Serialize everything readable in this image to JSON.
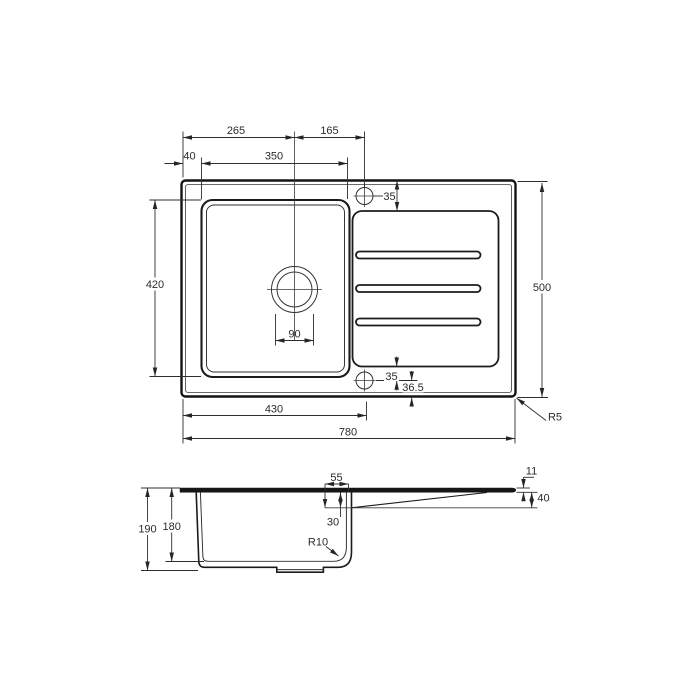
{
  "drawing": {
    "kind": "sink technical dimension drawing",
    "line_color": "#2b2b2b",
    "background": "#ffffff"
  },
  "plan": {
    "center_from_left": "265",
    "center_to_tap": "165",
    "bowl_offset": "40",
    "bowl_width": "350",
    "tap_top_offset": "35",
    "bowl_depth": "420",
    "drain_offset": "90",
    "tap_bottom_offset": "35",
    "tap_bottom_edge": "36.5",
    "bowl_zone_width": "430",
    "overall_width": "780",
    "overall_depth": "500",
    "corner_radius": "R5"
  },
  "section": {
    "tap_ledge": "55",
    "drainer_start_depth": "30",
    "bowl_bottom_radius": "R10",
    "overall_height": "190",
    "bowl_height": "180",
    "rim_height": "11",
    "drainer_end_depth": "40"
  }
}
